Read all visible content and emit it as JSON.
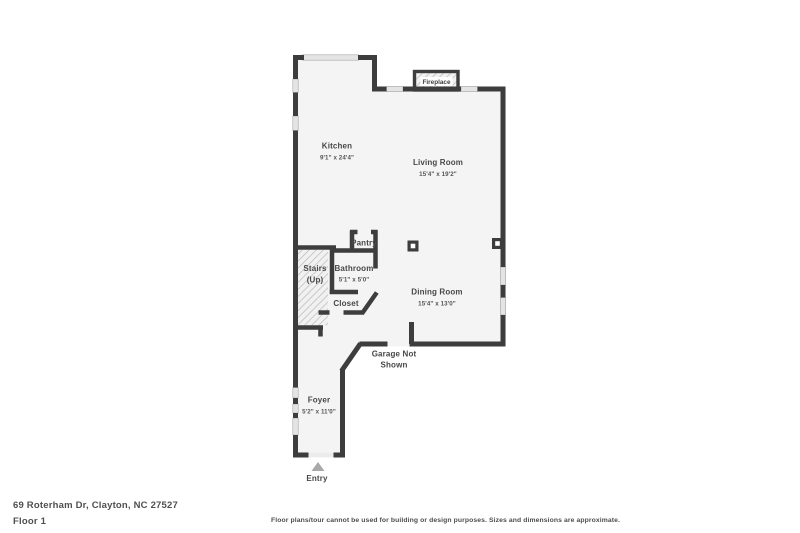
{
  "footer": {
    "address": "69 Roterham Dr, Clayton, NC 27527",
    "floor_label": "Floor 1",
    "disclaimer": "Floor plans/tour cannot be used for building or design purposes. Sizes and dimensions are approximate."
  },
  "floorplan": {
    "colors": {
      "wall": "#3d3d3d",
      "floor": "#f4f4f4",
      "window": "#e4e4e4",
      "hatch": "#b5b5b5",
      "entry_arrow": "#a9a9a9",
      "label": "#474747"
    },
    "fireplace_label": "Fireplace",
    "rooms": {
      "kitchen": {
        "name": "Kitchen",
        "dims": "9'1\" x 24'4\""
      },
      "living_room": {
        "name": "Living Room",
        "dims": "15'4\" x 19'2\""
      },
      "pantry": {
        "name": "Pantry"
      },
      "bathroom": {
        "name": "Bathroom",
        "dims": "5'1\" x 5'0\""
      },
      "stairs": {
        "name": "Stairs",
        "dims": "(Up)"
      },
      "closet": {
        "name": "Closet"
      },
      "dining_room": {
        "name": "Dining Room",
        "dims": "15'4\" x 13'0\""
      },
      "garage_note": {
        "line1": "Garage Not",
        "line2": "Shown"
      },
      "foyer": {
        "name": "Foyer",
        "dims": "5'2\" x 11'0\""
      },
      "entry": {
        "name": "Entry"
      }
    }
  }
}
